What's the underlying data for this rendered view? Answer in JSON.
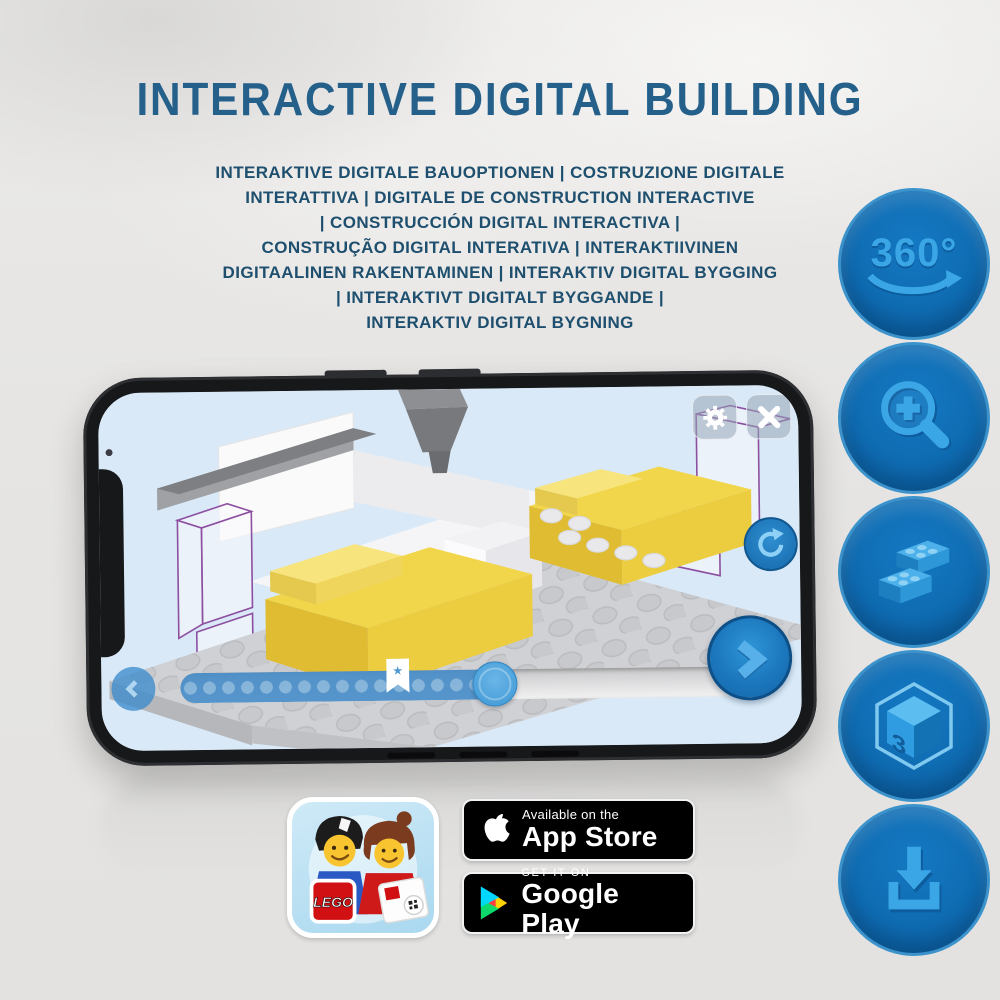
{
  "page": {
    "heading": "INTERACTIVE DIGITAL BUILDING",
    "subtitle_lines": [
      "INTERAKTIVE DIGITALE BAUOPTIONEN | COSTRUZIONE DIGITALE",
      "INTERATTIVA | DIGITALE DE CONSTRUCTION INTERACTIVE",
      "| CONSTRUCCIÓN DIGITAL INTERACTIVA |",
      "CONSTRUÇÃO DIGITAL INTERATIVA | INTERAKTIIVINEN",
      "DIGITAALINEN RAKENTAMINEN | INTERAKTIV DIGITAL BYGGING",
      "| INTERAKTIVT DIGITALT BYGGANDE |",
      "INTERAKTIV DIGITAL BYGNING"
    ]
  },
  "feature_icons": [
    {
      "name": "rotate-360-icon",
      "label": "360°"
    },
    {
      "name": "zoom-in-icon"
    },
    {
      "name": "bricks-icon"
    },
    {
      "name": "cube-3d-icon",
      "label_left": "3",
      "label_right": "D"
    },
    {
      "name": "download-icon"
    }
  ],
  "phone_app": {
    "controls": {
      "settings": "gear-icon",
      "close": "close-icon",
      "rotate": "rotate-icon",
      "back": "chevron-left-icon",
      "next": "chevron-right-icon",
      "bookmark": "star-bookmark",
      "bookmark_glyph": "★"
    }
  },
  "badges": {
    "lego_app": {
      "brand": "LEGO"
    },
    "app_store": {
      "tagline": "Available on the",
      "store": "App Store"
    },
    "google_play": {
      "tagline": "GET IT ON",
      "store": "Google Play"
    }
  },
  "colors": {
    "heading": "#24608a",
    "subtitle": "#1e4f6e",
    "icon_circle": "#0f6cb2",
    "icon_glyph": "#3ba6e6",
    "screen_sky": "#d9e9f7",
    "slider_fill": "#488dc8",
    "accent_button": "#1b79c4",
    "brick_yellow": "#f1d64b",
    "ghost_outline": "#8d4fa0",
    "badge_bg": "#000000"
  }
}
